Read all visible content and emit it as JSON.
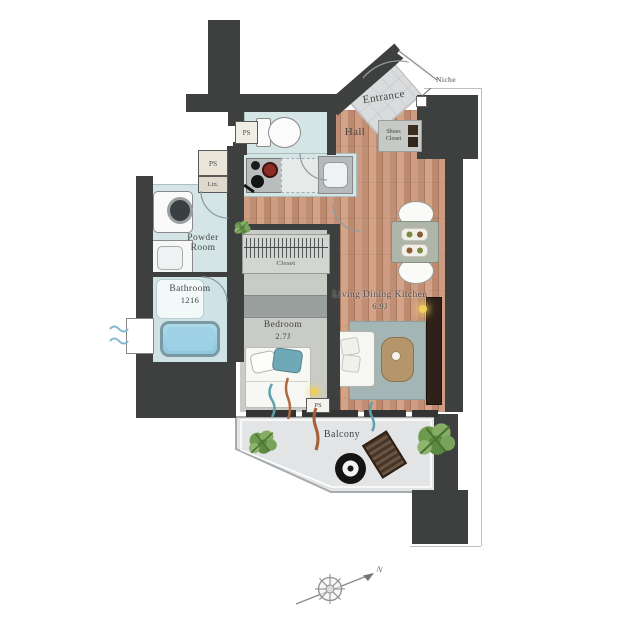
{
  "labels": {
    "niche": "Niche",
    "entrance": "Entrance",
    "hall": "Hall",
    "shoes_closet_line1": "Shoes",
    "shoes_closet_line2": "Closet",
    "ps": "PS",
    "lin": "Lin.",
    "powder_room_line1": "Powder",
    "powder_room_line2": "Room",
    "bathroom": "Bathroom",
    "bathroom_size": "1216",
    "closet": "Closet",
    "bedroom": "Bedroom",
    "bedroom_size": "2.7J",
    "ldk": "Living Dining Kitchen",
    "ldk_size": "6.9J",
    "balcony": "Balcony"
  },
  "compass": {
    "north": "N"
  },
  "colors": {
    "wall": "#3e403f",
    "wood_floor": "#c6937a",
    "wet_room": "#d5e4e5",
    "tile": "#d9dbdd",
    "bathtub_water": "#9fd2e6",
    "rug": "#a3b6b5",
    "pillow_teal": "#6fa8b6",
    "table_wood": "#b5966a",
    "tv_board": "#2f2119",
    "lamp": "#f2cf5b",
    "plant": "#6d9a4e",
    "label_text": "#454545"
  }
}
